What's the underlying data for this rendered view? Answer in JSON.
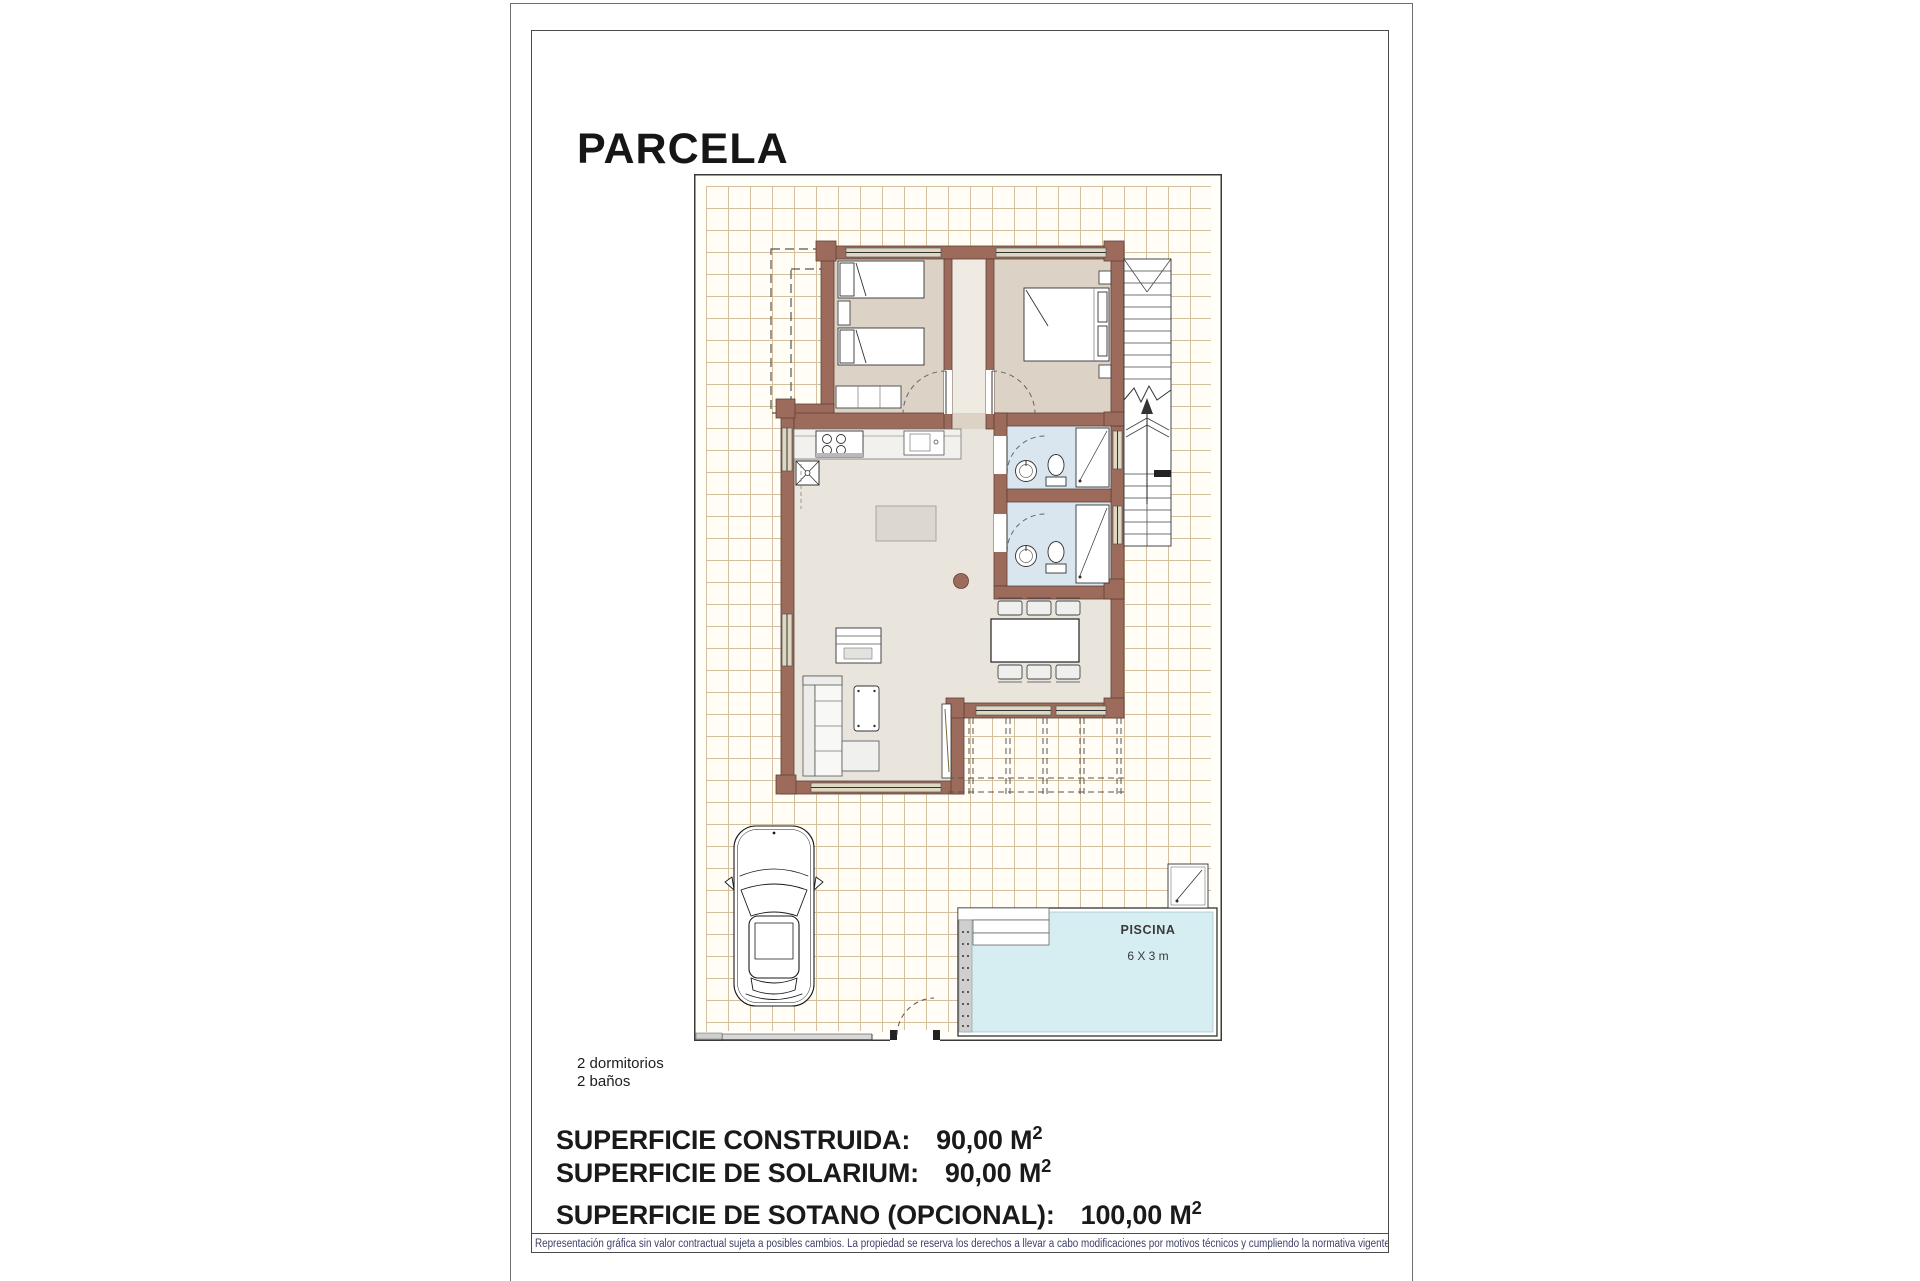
{
  "page": {
    "title": "PARCELA"
  },
  "plan": {
    "pool": {
      "label": "PISCINA",
      "size": "6 X 3 m"
    }
  },
  "summary": {
    "line1": "2 dormitorios",
    "line2": "2 baños"
  },
  "areas": [
    {
      "label": "SUPERFICIE CONSTRUIDA:",
      "value": "90,00",
      "unit": "M",
      "sup": "2"
    },
    {
      "label": "SUPERFICIE DE SOLARIUM:",
      "value": "90,00",
      "unit": "M",
      "sup": "2"
    },
    {
      "label": "SUPERFICIE DE SOTANO (OPCIONAL):",
      "value": "100,00",
      "unit": "M",
      "sup": "2"
    }
  ],
  "disclaimer": "Representación gráfica sin valor contractual sujeta a posibles cambios. La propiedad se reserva los derechos a llevar a cabo modificaciones por motivos técnicos y cumpliendo la normativa vigente.",
  "colors": {
    "wall": "#9c6b5c",
    "bedroom_floor": "#ddd2c6",
    "living_floor": "#e9e4dc",
    "bath_floor": "#d9e6ef",
    "pool_water": "#d6edf1",
    "grid_line": "#d4bf9f",
    "disclaimer_text": "#3f3f66"
  }
}
